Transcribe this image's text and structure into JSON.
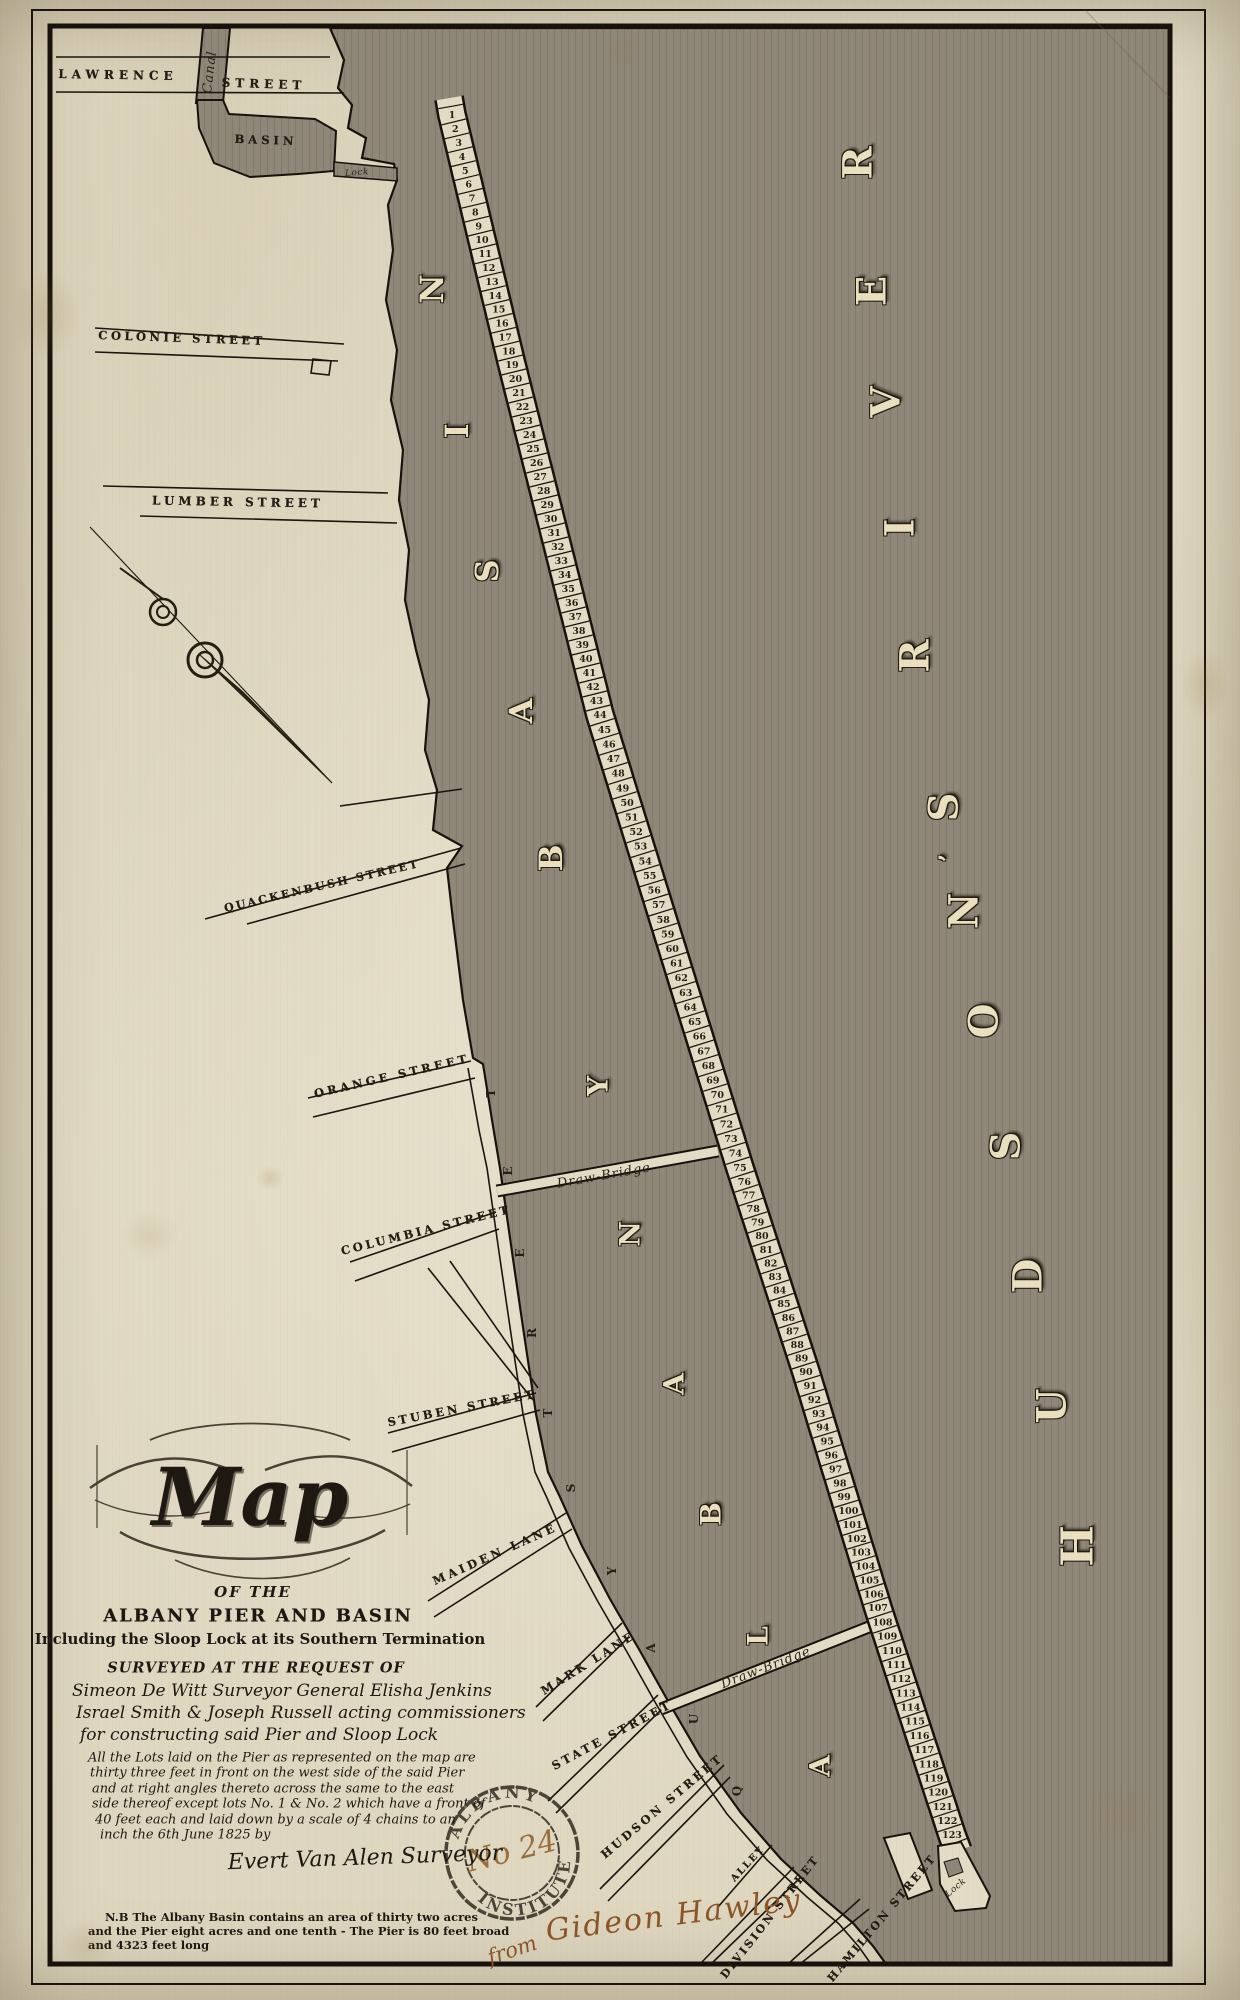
{
  "page": {
    "title": "Map of the Albany Pier and Basin"
  },
  "map": {
    "labels": [
      {
        "id": "lawrence-street-1",
        "text": "LAWRENCE",
        "x": 118,
        "y": 75,
        "rot": 1,
        "fs": 12,
        "ls": 5,
        "cls": "slabel"
      },
      {
        "id": "lawrence-street-2",
        "text": "STREET",
        "x": 264,
        "y": 84,
        "rot": 2,
        "fs": 12,
        "ls": 5,
        "cls": "slabel"
      },
      {
        "id": "canal",
        "text": "Canal",
        "x": 210,
        "y": 72,
        "rot": -83,
        "fs": 13,
        "ls": 1,
        "cls": "script"
      },
      {
        "id": "basin-north",
        "text": "BASIN",
        "x": 266,
        "y": 140,
        "rot": 2,
        "fs": 11.5,
        "ls": 4,
        "cls": "slabel"
      },
      {
        "id": "lock-north",
        "text": "Lock",
        "x": 357,
        "y": 173,
        "rot": -4,
        "fs": 9,
        "ls": 0.5,
        "cls": "script"
      },
      {
        "id": "colonie-street",
        "text": "COLONIE STREET",
        "x": 182,
        "y": 338,
        "rot": 2,
        "fs": 11.5,
        "ls": 3.5,
        "cls": "slabel"
      },
      {
        "id": "lumber-street",
        "text": "LUMBER STREET",
        "x": 238,
        "y": 502,
        "rot": 1,
        "fs": 12,
        "ls": 4,
        "cls": "slabel"
      },
      {
        "id": "quackenbush-street",
        "text": "QUACKENBUSH STREET",
        "x": 322,
        "y": 886,
        "rot": -13,
        "fs": 11,
        "ls": 2.5,
        "cls": "slabel"
      },
      {
        "id": "orange-street",
        "text": "ORANGE STREET",
        "x": 392,
        "y": 1076,
        "rot": -13,
        "fs": 11.5,
        "ls": 3.5,
        "cls": "slabel"
      },
      {
        "id": "columbia-street",
        "text": "COLUMBIA STREET",
        "x": 426,
        "y": 1230,
        "rot": -14,
        "fs": 11.5,
        "ls": 3,
        "cls": "slabel"
      },
      {
        "id": "stuben-street",
        "text": "STUBEN STREET",
        "x": 462,
        "y": 1408,
        "rot": -11,
        "fs": 11.5,
        "ls": 3,
        "cls": "slabel"
      },
      {
        "id": "maiden-lane",
        "text": "MAIDEN LANE",
        "x": 495,
        "y": 1554,
        "rot": -24,
        "fs": 11.5,
        "ls": 3.5,
        "cls": "slabel"
      },
      {
        "id": "mark-lane",
        "text": "MARK LANE",
        "x": 588,
        "y": 1663,
        "rot": -32,
        "fs": 11.5,
        "ls": 3,
        "cls": "slabel"
      },
      {
        "id": "state-street",
        "text": "STATE STREET",
        "x": 612,
        "y": 1735,
        "rot": -28,
        "fs": 11.5,
        "ls": 3,
        "cls": "slabel"
      },
      {
        "id": "hudson-street",
        "text": "HUDSON STREET",
        "x": 662,
        "y": 1806,
        "rot": -40,
        "fs": 11.5,
        "ls": 3,
        "cls": "slabel"
      },
      {
        "id": "alley",
        "text": "ALLEY",
        "x": 748,
        "y": 1864,
        "rot": -47,
        "fs": 9.5,
        "ls": 2,
        "cls": "slabel"
      },
      {
        "id": "division-street",
        "text": "DIVISION STREET",
        "x": 770,
        "y": 1917,
        "rot": -52,
        "fs": 11,
        "ls": 2.5,
        "cls": "slabel"
      },
      {
        "id": "hamilton-street",
        "text": "HAMILTON STREET",
        "x": 882,
        "y": 1918,
        "rot": -50,
        "fs": 11,
        "ls": 2.5,
        "cls": "slabel"
      },
      {
        "id": "draw-bridge-1",
        "text": "Draw-Bridge",
        "x": 604,
        "y": 1176,
        "rot": -10,
        "fs": 13,
        "ls": 1,
        "cls": "script"
      },
      {
        "id": "draw-bridge-2",
        "text": "Draw-Bridge",
        "x": 766,
        "y": 1668,
        "rot": -21,
        "fs": 13,
        "ls": 1,
        "cls": "script"
      },
      {
        "id": "lock-tip",
        "text": "Lock",
        "x": 956,
        "y": 1888,
        "rot": -40,
        "fs": 9,
        "ls": 0.5,
        "cls": "script"
      }
    ],
    "big_letters": {
      "basin_word": [
        {
          "ch": "N",
          "x": 432,
          "y": 289
        },
        {
          "ch": "I",
          "x": 457,
          "y": 431
        },
        {
          "ch": "S",
          "x": 487,
          "y": 571
        },
        {
          "ch": "A",
          "x": 521,
          "y": 711
        },
        {
          "ch": "B",
          "x": 551,
          "y": 858
        }
      ],
      "albany_word": [
        {
          "ch": "Y",
          "x": 598,
          "y": 1086
        },
        {
          "ch": "N",
          "x": 630,
          "y": 1234
        },
        {
          "ch": "A",
          "x": 674,
          "y": 1384
        },
        {
          "ch": "B",
          "x": 711,
          "y": 1514
        },
        {
          "ch": "L",
          "x": 758,
          "y": 1636
        },
        {
          "ch": "A",
          "x": 820,
          "y": 1766
        }
      ],
      "river_word": [
        {
          "ch": "R",
          "x": 858,
          "y": 163
        },
        {
          "ch": "E",
          "x": 872,
          "y": 291
        },
        {
          "ch": "V",
          "x": 886,
          "y": 402
        },
        {
          "ch": "I",
          "x": 900,
          "y": 528
        },
        {
          "ch": "R",
          "x": 915,
          "y": 656
        },
        {
          "ch": "S",
          "x": 944,
          "y": 807
        },
        {
          "ch": "’",
          "x": 948,
          "y": 858,
          "size": 24
        },
        {
          "ch": "N",
          "x": 964,
          "y": 911
        },
        {
          "ch": "O",
          "x": 984,
          "y": 1021
        },
        {
          "ch": "S",
          "x": 1006,
          "y": 1146
        },
        {
          "ch": "D",
          "x": 1028,
          "y": 1276
        },
        {
          "ch": "U",
          "x": 1052,
          "y": 1406
        },
        {
          "ch": "H",
          "x": 1078,
          "y": 1546,
          "size": 44
        }
      ]
    },
    "quay_letters": [
      {
        "ch": "T",
        "x": 491,
        "y": 1093
      },
      {
        "ch": "E",
        "x": 508,
        "y": 1171
      },
      {
        "ch": "E",
        "x": 520,
        "y": 1253
      },
      {
        "ch": "R",
        "x": 532,
        "y": 1333
      },
      {
        "ch": "T",
        "x": 548,
        "y": 1413
      },
      {
        "ch": "S",
        "x": 571,
        "y": 1488
      },
      {
        "ch": "Y",
        "x": 612,
        "y": 1571
      },
      {
        "ch": "A",
        "x": 651,
        "y": 1648
      },
      {
        "ch": "U",
        "x": 694,
        "y": 1719
      },
      {
        "ch": "Q",
        "x": 737,
        "y": 1791
      }
    ],
    "pier": {
      "lot_first": 1,
      "lot_last": 123
    }
  },
  "cartouche": {
    "map_word": "Map",
    "of_the": "OF THE",
    "title_line": "ALBANY PIER AND BASIN",
    "subtitle": "Including the Sloop Lock at its Southern Termination",
    "surveyed": "SURVEYED AT THE REQUEST OF",
    "script_lines": [
      "Simeon De Witt Surveyor General  Elisha Jenkins",
      "Israel Smith  &  Joseph Russell  acting commissioners",
      "for constructing  said  Pier and Sloop Lock"
    ],
    "note_lines": [
      "All the Lots laid on the Pier as represented on the map are",
      "thirty three feet in front on the west side of the said Pier",
      "and at right angles thereto across the same to the east",
      "side thereof except lots No. 1 & No. 2 which have a front of",
      "40 feet each and laid down by a scale of 4 chains to an",
      "inch the 6th June 1825 by"
    ],
    "surveyor": "Evert Van Alen Surveyor",
    "nb_lines": [
      "N.B  The Albany Basin contains an area of thirty two acres",
      "and the Pier eight acres and one tenth - The Pier is 80 feet broad",
      "and 4323 feet long"
    ]
  },
  "annotations": {
    "stamp_text_top": "ALBANY",
    "stamp_text_bottom": "INSTITUTE",
    "stamp_number": "No 24",
    "inscription_from": "from",
    "inscription_name": "Gideon Hawley"
  },
  "colors": {
    "paper": "#ded6bf",
    "water": "#8e8677",
    "pier": "#e3dbc3",
    "ink": "#1f1a12",
    "brown_ink": "#8a5424"
  }
}
